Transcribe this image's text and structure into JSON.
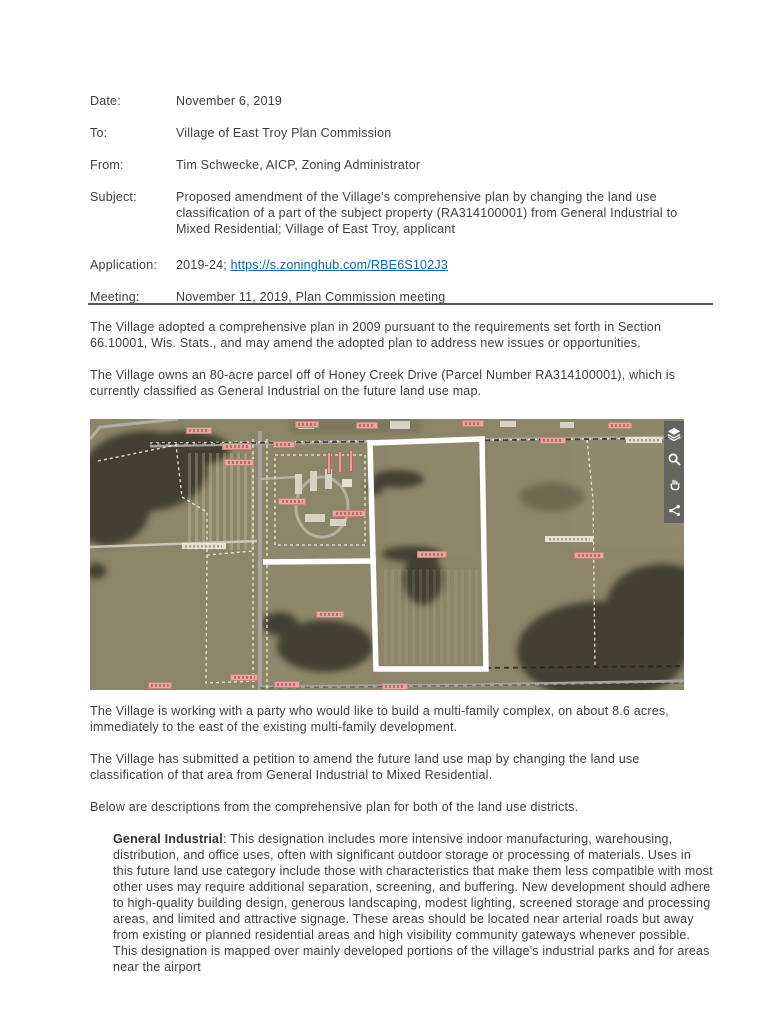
{
  "memo": {
    "fields": [
      {
        "label": "Date:",
        "value": "November 6, 2019"
      },
      {
        "label": "To:",
        "value": "Village of East Troy Plan Commission"
      },
      {
        "label": "From:",
        "value": "Tim Schwecke, AICP, Zoning Administrator"
      },
      {
        "label": "Subject:",
        "value": "Proposed amendment of the Village's comprehensive plan by changing the land use classification of a part of the subject property (RA314100001) from General Industrial to Mixed Residential; Village of East Troy, applicant"
      },
      {
        "label": "Application:",
        "value_prefix": "2019-24; ",
        "link": "https://s.zoninghub.com/RBE6S102J3"
      },
      {
        "label": "Meeting:",
        "value": "November 11, 2019, Plan Commission meeting"
      }
    ],
    "paragraphs": [
      "The Village adopted a comprehensive plan in 2009 pursuant to the requirements set forth in Section 66.10001, Wis. Stats., and may amend the adopted plan to address new issues or opportunities.",
      "The Village owns an 80-acre parcel off of Honey Creek Drive (Parcel Number RA314100001), which is currently classified as General Industrial on the future land use map.",
      "The Village is working with a party who would like to build a multi-family complex, on about 8.6 acres, immediately to the east of the existing multi-family development.",
      "The Village has submitted a petition to amend the future land use map by changing the land use classification of that area from General Industrial to Mixed Residential.",
      "Below are descriptions from the comprehensive plan for both of the land use districts."
    ],
    "district": {
      "term": "General Industrial",
      "text": ": This designation includes more intensive indoor manufacturing, warehousing, distribution, and office uses, often with significant outdoor storage or processing of materials. Uses in this future land use category include those with characteristics that make them less compatible with most other uses may require additional separation, screening, and buffering. New development should adhere to high-quality building design, generous landscaping, modest lighting, screened storage and processing areas, and limited and attractive signage. These areas should be located near arterial roads but away from existing or planned residential areas and high visibility community gateways whenever possible. This designation is mapped over mainly developed portions of the village's industrial parks and for areas near the airport"
    }
  },
  "colors": {
    "text": "#3e3e3e",
    "link": "#0563c1",
    "rule": "#565656",
    "map_base": "#8b8569",
    "parcel_marker": "#e5a7a2",
    "subject_outline": "#ffffff"
  },
  "map": {
    "type": "aerial-imagery",
    "subject_parcel_outline_color": "#ffffff",
    "outline_points": "280,24 392,20 396,250 286,250",
    "outline_arm_path": "M286,142 L173,143",
    "toolbar_icons": [
      "layers-icon",
      "search-icon",
      "hand-tool-icon",
      "share-icon"
    ],
    "markers": [
      {
        "kind": "parcel-id",
        "x": 96,
        "y": 8
      },
      {
        "kind": "parcel-id",
        "x": 132,
        "y": 24,
        "w": 30
      },
      {
        "kind": "parcel-id",
        "x": 134,
        "y": 40,
        "w": 30
      },
      {
        "kind": "parcel-id",
        "x": 205,
        "y": 2,
        "w": 24
      },
      {
        "kind": "parcel-id",
        "x": 266,
        "y": 3,
        "w": 22
      },
      {
        "kind": "parcel-id",
        "x": 183,
        "y": 22,
        "w": 22
      },
      {
        "kind": "parcel-id",
        "x": 188,
        "y": 79,
        "w": 28
      },
      {
        "kind": "parcel-id",
        "x": 242,
        "y": 91,
        "w": 34
      },
      {
        "kind": "parcel-id",
        "x": 226,
        "y": 192,
        "w": 28
      },
      {
        "kind": "parcel-id",
        "x": 327,
        "y": 132,
        "w": 30
      },
      {
        "kind": "parcel-id",
        "x": 450,
        "y": 18,
        "w": 26
      },
      {
        "kind": "parcel-id",
        "x": 484,
        "y": 133,
        "w": 30
      },
      {
        "kind": "parcel-id",
        "x": 140,
        "y": 255,
        "w": 28
      },
      {
        "kind": "parcel-id",
        "x": 184,
        "y": 262,
        "w": 26
      },
      {
        "kind": "parcel-id",
        "x": 372,
        "y": 1,
        "w": 22
      },
      {
        "kind": "parcel-id",
        "x": 518,
        "y": 3,
        "w": 24
      },
      {
        "kind": "parcel-id",
        "x": 292,
        "y": 264,
        "w": 26
      },
      {
        "kind": "parcel-id",
        "x": 58,
        "y": 263,
        "w": 24
      },
      {
        "kind": "street-name",
        "x": 92,
        "y": 124,
        "w": 44
      },
      {
        "kind": "street-name",
        "x": 455,
        "y": 117,
        "w": 48
      },
      {
        "kind": "street-name",
        "x": 536,
        "y": 18,
        "w": 36
      },
      {
        "kind": "building-bar",
        "x": 237,
        "y": 33
      },
      {
        "kind": "building-bar",
        "x": 248,
        "y": 32
      },
      {
        "kind": "building-bar",
        "x": 259,
        "y": 31
      }
    ]
  }
}
